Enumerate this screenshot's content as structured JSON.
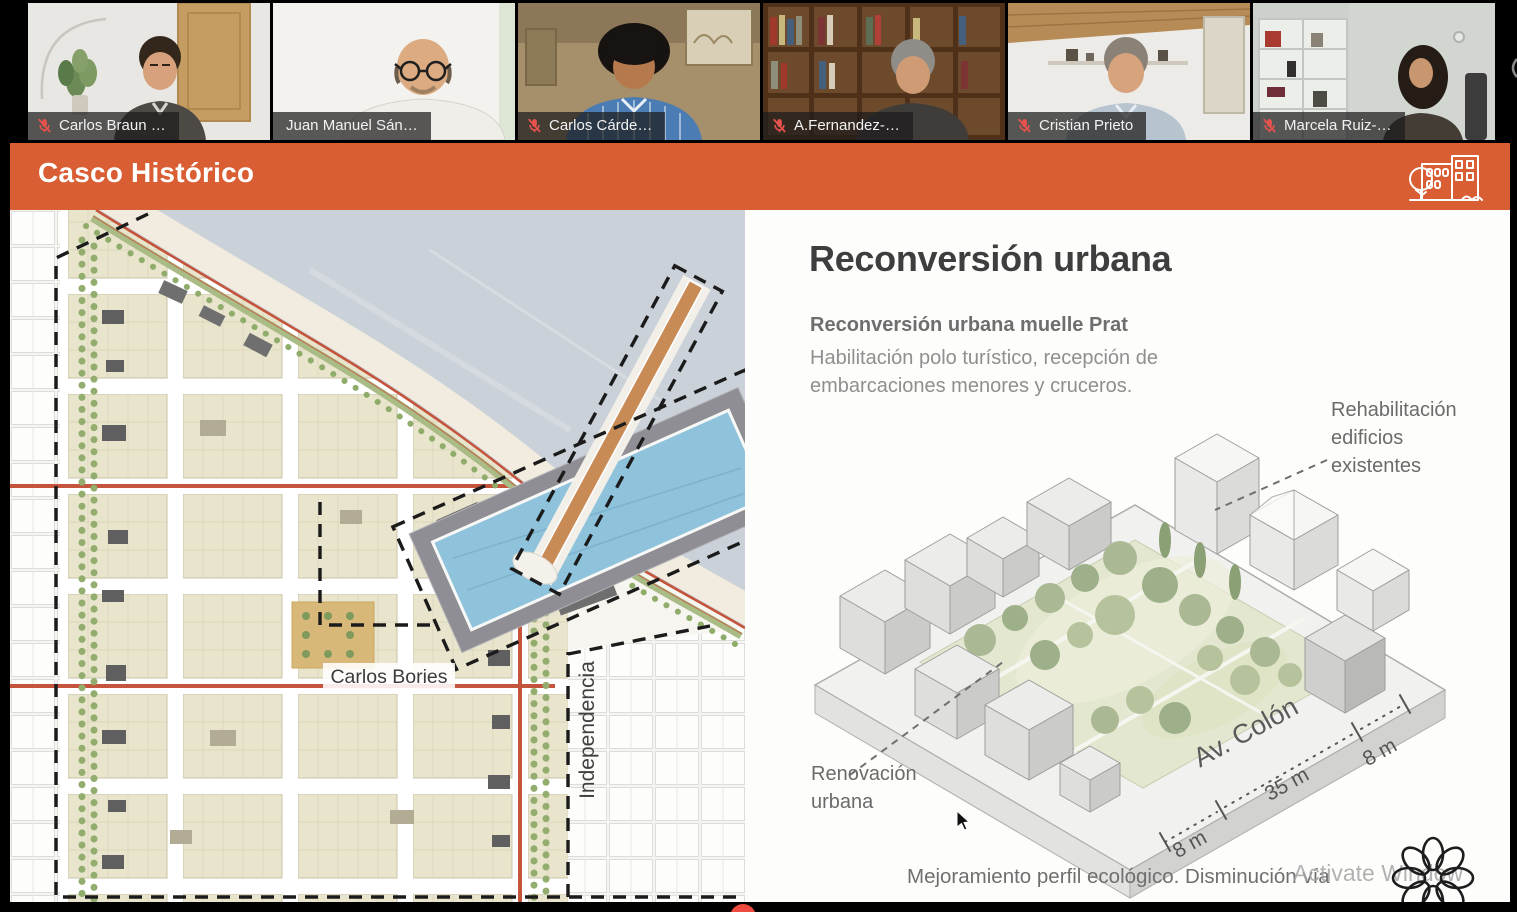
{
  "meeting": {
    "participants": [
      {
        "name": "Carlos Braun …",
        "muted": true,
        "active": false
      },
      {
        "name": "Juan Manuel Sán…",
        "muted": false,
        "active": true
      },
      {
        "name": "Carlos Cárde…",
        "muted": true,
        "active": false
      },
      {
        "name": "A.Fernandez-…",
        "muted": true,
        "active": false
      },
      {
        "name": "Cristian Prieto",
        "muted": true,
        "active": false
      },
      {
        "name": "Marcela Ruiz-…",
        "muted": true,
        "active": false
      }
    ]
  },
  "slide": {
    "header": {
      "title": "Casco Histórico"
    },
    "map": {
      "street_label_horizontal": "Carlos Bories",
      "street_label_vertical": "Independencia"
    },
    "panel": {
      "title": "Reconversión urbana",
      "subtitle": "Reconversión urbana muelle Prat",
      "body_line1": "Habilitación polo turístico, recepción de",
      "body_line2": "embarcaciones menores y cruceros.",
      "rehab_lines": [
        "Rehabilitación",
        "edificios",
        "existentes"
      ],
      "renov_lines": [
        "Renovación",
        "urbana"
      ],
      "street_name": "Av. Colón",
      "dims": {
        "left": "8 m",
        "middle": "35 m",
        "right": "8 m"
      },
      "footer": "Mejoramiento perfil ecológico. Disminución vía"
    }
  },
  "overlay": {
    "watermark": "Activate Window"
  },
  "colors": {
    "accent_orange": "#d95e33",
    "active_speaker_green": "#9ab64a",
    "muted_mic_red": "#e8524d",
    "map_water": "#cad1d8",
    "map_block_beige": "#e9e5cd",
    "map_street_red": "#c4553c",
    "marina_gray": "#8e8e94",
    "basin_blue": "#8fc3dc",
    "pier_brown": "#c98b56"
  }
}
